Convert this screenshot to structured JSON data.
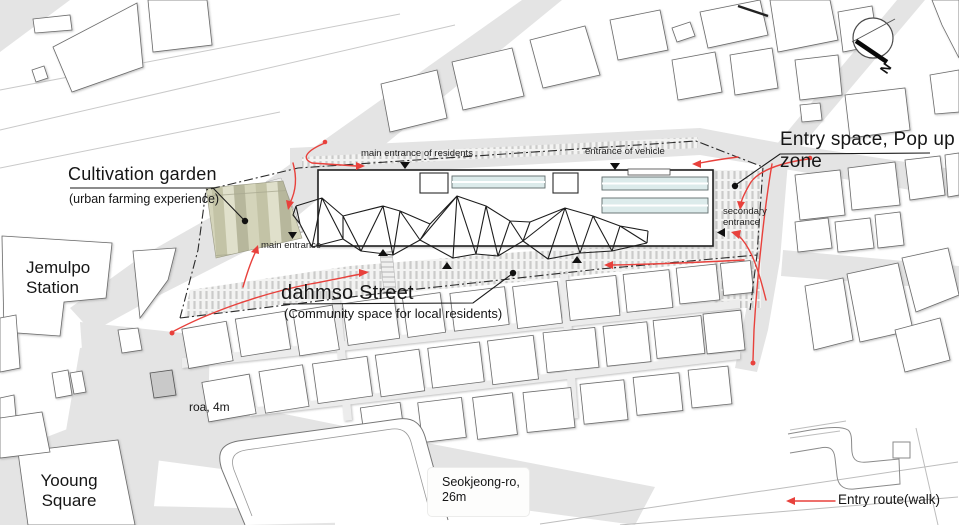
{
  "colors": {
    "accent": "#e8413c",
    "road": "#e4e4e4",
    "skylight": "#dcebeb",
    "garden1": "#b7b79c",
    "garden2": "#d4d4ba",
    "garden3": "#c3c3a6",
    "garden4": "#e0e0cb"
  },
  "labels": {
    "cultivation_garden": {
      "title": "Cultivation garden",
      "subtitle": "(urban farming experience)"
    },
    "entry_space": {
      "title": "Entry space, Pop up zone"
    },
    "dahmso_street": {
      "title": "dahmso Street",
      "subtitle": "(Community space for local residents)"
    },
    "jemulpo_station": "Jemulpo\nStation",
    "yooung_square": "Yooung\nSquare",
    "main_entrance_residents": "main entrance of residents",
    "entrance_of_vehicle": "entrance of vehicle",
    "secondary_entrance": "secondary\nentrance",
    "main_entrance": "main entrance",
    "road_4m": "roa, 4m",
    "seokjeong_ro": "Seokjeong-ro,\n26m",
    "entry_route": "Entry route(walk)",
    "north": "N"
  }
}
